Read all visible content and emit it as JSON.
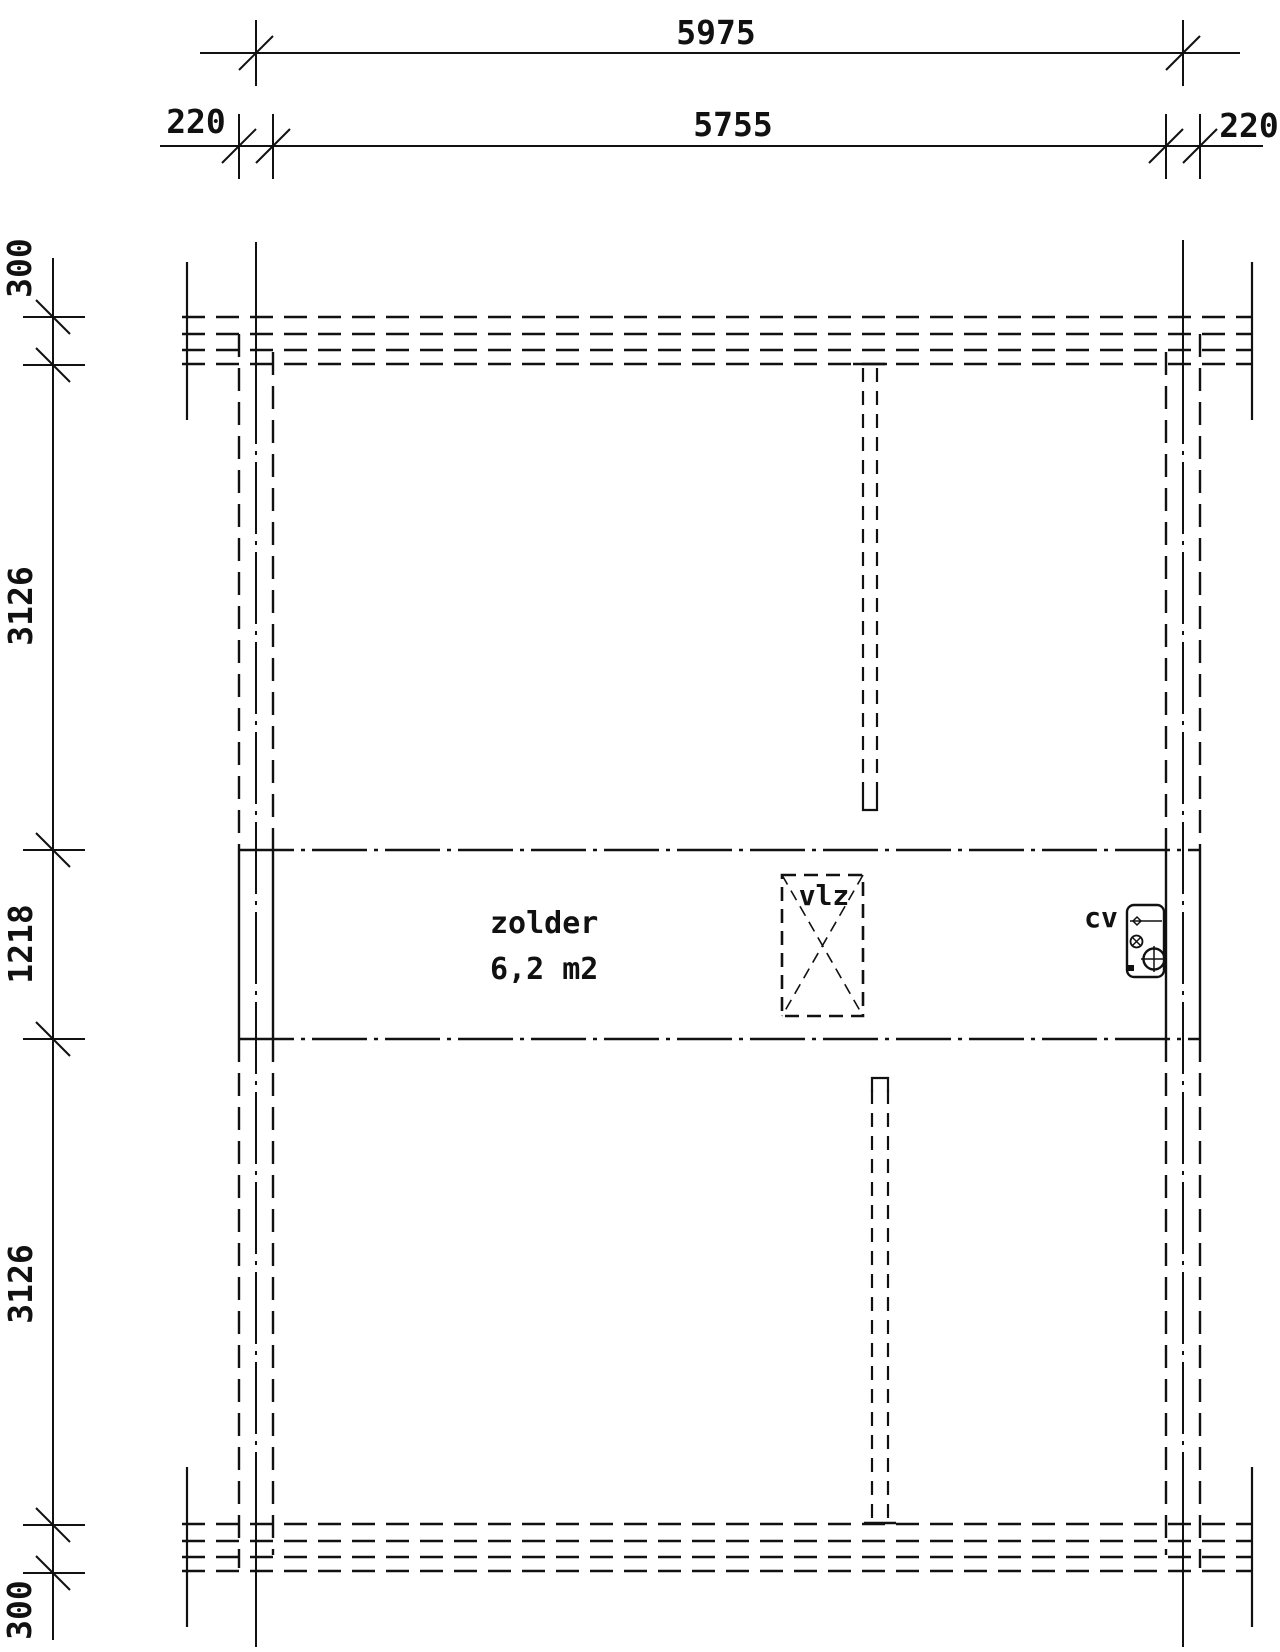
{
  "meta": {
    "drawing_type": "attic floor plan",
    "background_color": "#ffffff",
    "line_color": "#111111"
  },
  "dimensions_top": {
    "overall": "5975",
    "left_wall": "220",
    "inner_width": "5755",
    "right_wall": "220"
  },
  "dimensions_left": {
    "top_wall": "300",
    "upper_bay": "3126",
    "middle_bay": "1218",
    "lower_bay": "3126",
    "bottom_wall": "300"
  },
  "room": {
    "name": "zolder",
    "area": "6,2 m2"
  },
  "fixtures": {
    "vlz_label": "vlz",
    "cv_label": "cv"
  }
}
